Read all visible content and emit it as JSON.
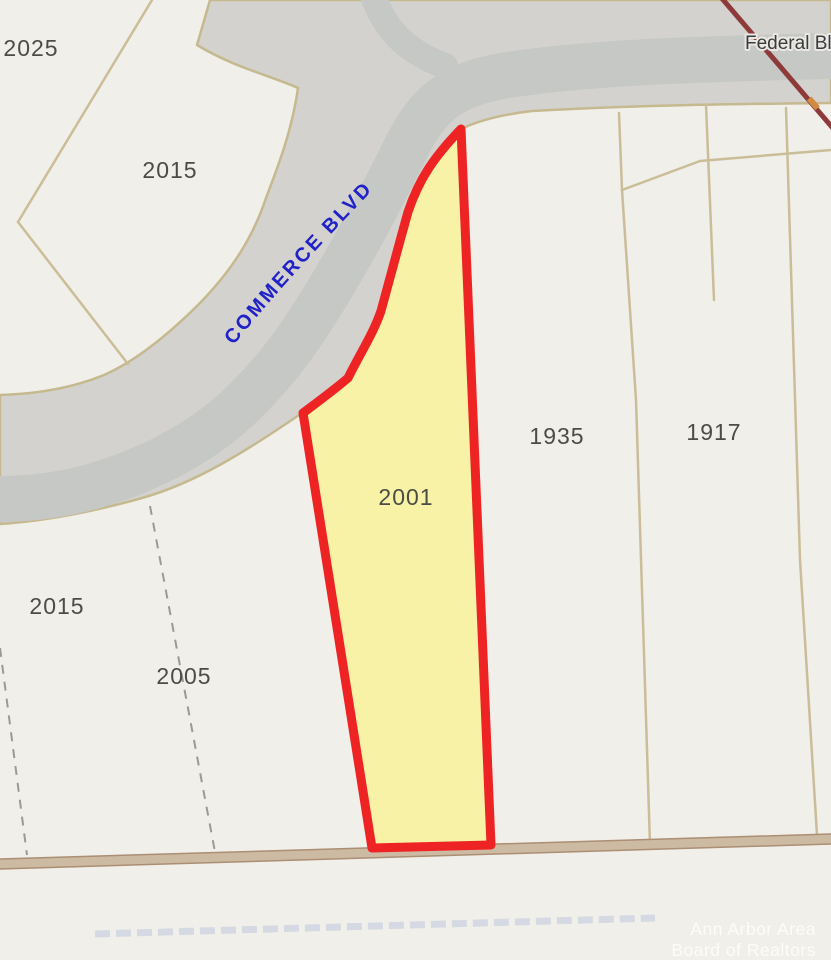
{
  "roads": {
    "commerce": "COMMERCE BLVD",
    "federal": "Federal Blvd"
  },
  "highlighted_parcel": {
    "label": "2001",
    "fill_color": "#f7f1a1",
    "outline_color": "#ee2424"
  },
  "parcel_labels": {
    "p2025": "2025",
    "p2015_top": "2015",
    "p1935": "1935",
    "p1917": "1917",
    "p2015_bottom": "2015",
    "p2005": "2005"
  },
  "watermark": {
    "line1": "Ann Arbor Area",
    "line2": "Board of Realtors"
  },
  "colors": {
    "background": "#f1efe9",
    "road_fill": "#d3d2ce",
    "road_center_band": "#c6c8c5",
    "parcel_line": "#cabd98",
    "section_line_band": "#cdbaa2",
    "section_line_edge": "#ab8e74",
    "railroad_line": "#8e393a",
    "commerce_text": "#2121c8",
    "federal_text": "#3b3b3b",
    "parcel_label_text": "#4c4c46",
    "highlight_marker": "#d08a42"
  }
}
